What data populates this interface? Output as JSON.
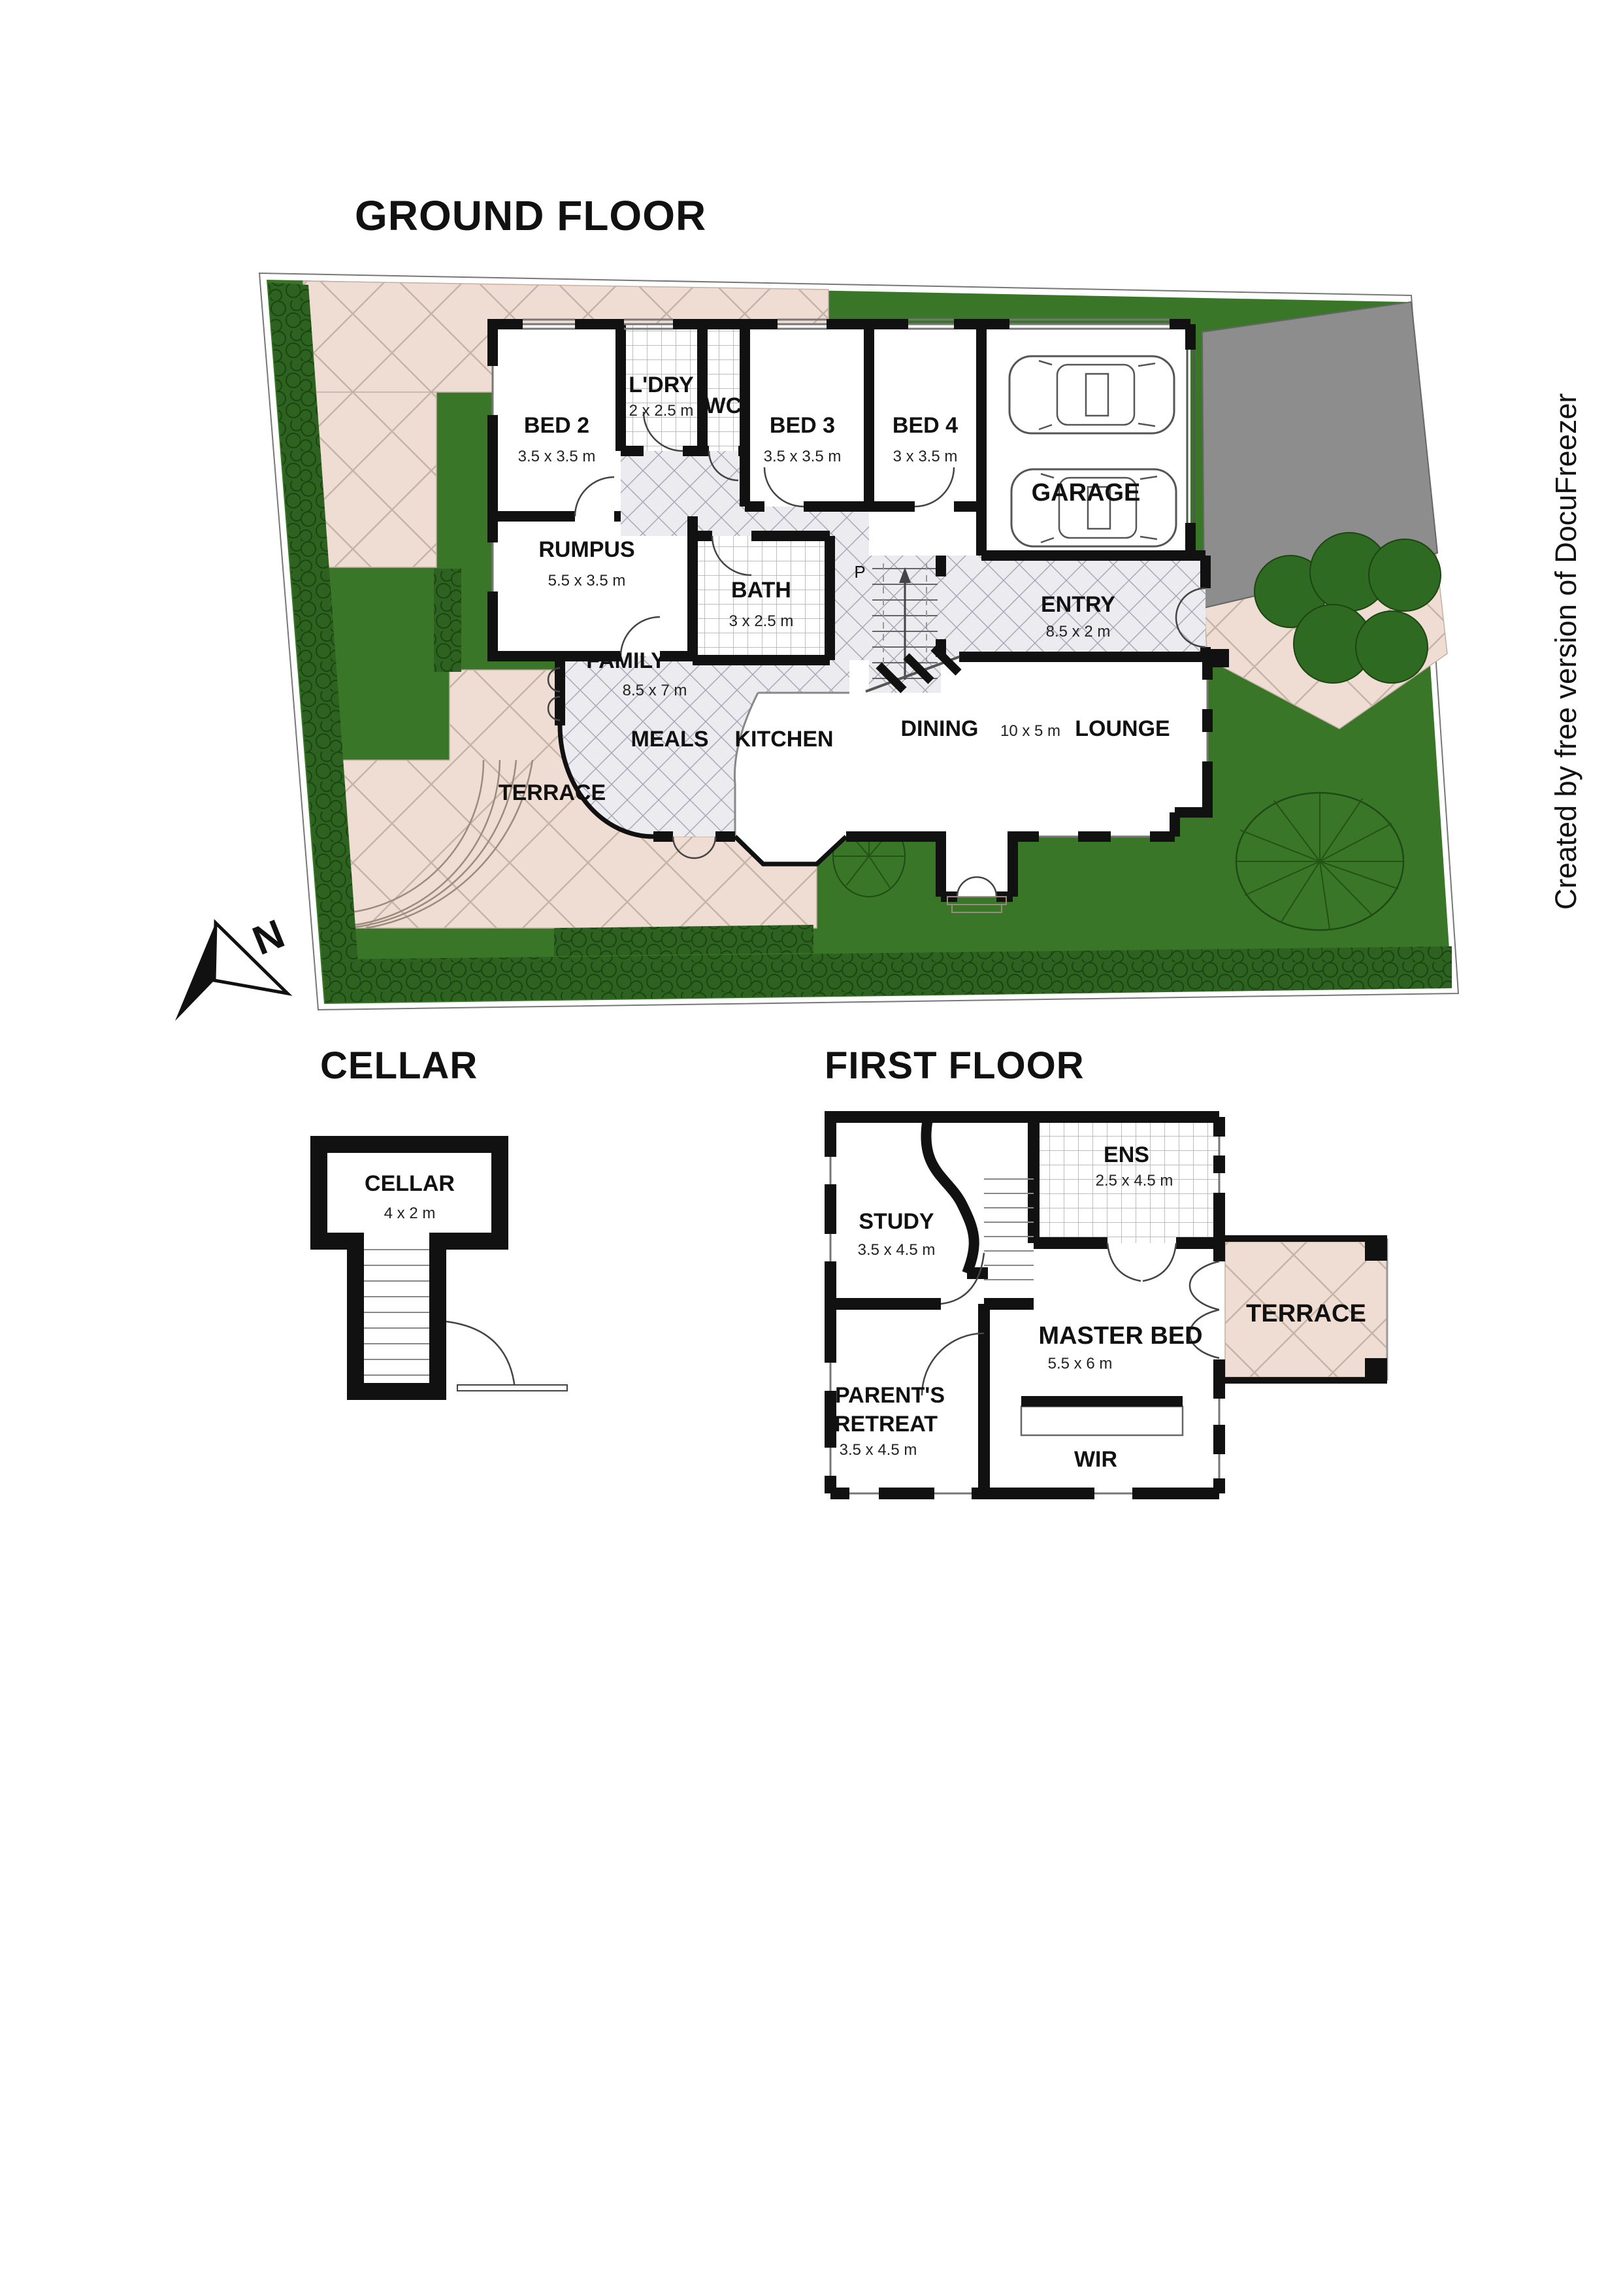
{
  "watermark": {
    "text": "Created by free version of DocuFreezer",
    "color": "#26265e"
  },
  "compass": {
    "north_label": "N"
  },
  "colors": {
    "lawn": "#3a7628",
    "hedge": "#2d6220",
    "paving": "#efddd3",
    "paving_line": "#c7b4a8",
    "driveway": "#8d8d8d",
    "wall": "#111111",
    "interior_hatch": "#ebebf0",
    "watermark_text": "#26265e"
  },
  "ground_floor": {
    "title": "GROUND FLOOR",
    "stair_label": "P",
    "rooms": {
      "bed2": {
        "name": "BED 2",
        "dims": "3.5 x 3.5 m"
      },
      "ldry": {
        "name": "L'DRY",
        "dims": "2 x 2.5 m"
      },
      "wc": {
        "name": "WC"
      },
      "bed3": {
        "name": "BED 3",
        "dims": "3.5 x 3.5 m"
      },
      "bed4": {
        "name": "BED 4",
        "dims": "3 x 3.5 m"
      },
      "garage": {
        "name": "GARAGE"
      },
      "rumpus": {
        "name": "RUMPUS",
        "dims": "5.5 x 3.5 m"
      },
      "bath": {
        "name": "BATH",
        "dims": "3 x 2.5 m"
      },
      "entry": {
        "name": "ENTRY",
        "dims": "8.5 x 2 m"
      },
      "family": {
        "name": "FAMILY",
        "dims": "8.5 x 7 m"
      },
      "meals": {
        "name": "MEALS"
      },
      "kitchen": {
        "name": "KITCHEN"
      },
      "dining": {
        "name": "DINING",
        "dims": "10 x 5 m"
      },
      "lounge": {
        "name": "LOUNGE"
      },
      "terrace": {
        "name": "TERRACE"
      }
    }
  },
  "cellar": {
    "title": "CELLAR",
    "room": {
      "name": "CELLAR",
      "dims": "4 x 2 m"
    }
  },
  "first_floor": {
    "title": "FIRST FLOOR",
    "rooms": {
      "study": {
        "name": "STUDY",
        "dims": "3.5 x 4.5 m"
      },
      "ens": {
        "name": "ENS",
        "dims": "2.5 x 4.5 m"
      },
      "master": {
        "name": "MASTER BED",
        "dims": "5.5 x 6 m"
      },
      "retreat": {
        "name_l1": "PARENT'S",
        "name_l2": "RETREAT",
        "dims": "3.5 x 4.5 m"
      },
      "wir": {
        "name": "WIR"
      },
      "terrace": {
        "name": "TERRACE"
      }
    }
  }
}
